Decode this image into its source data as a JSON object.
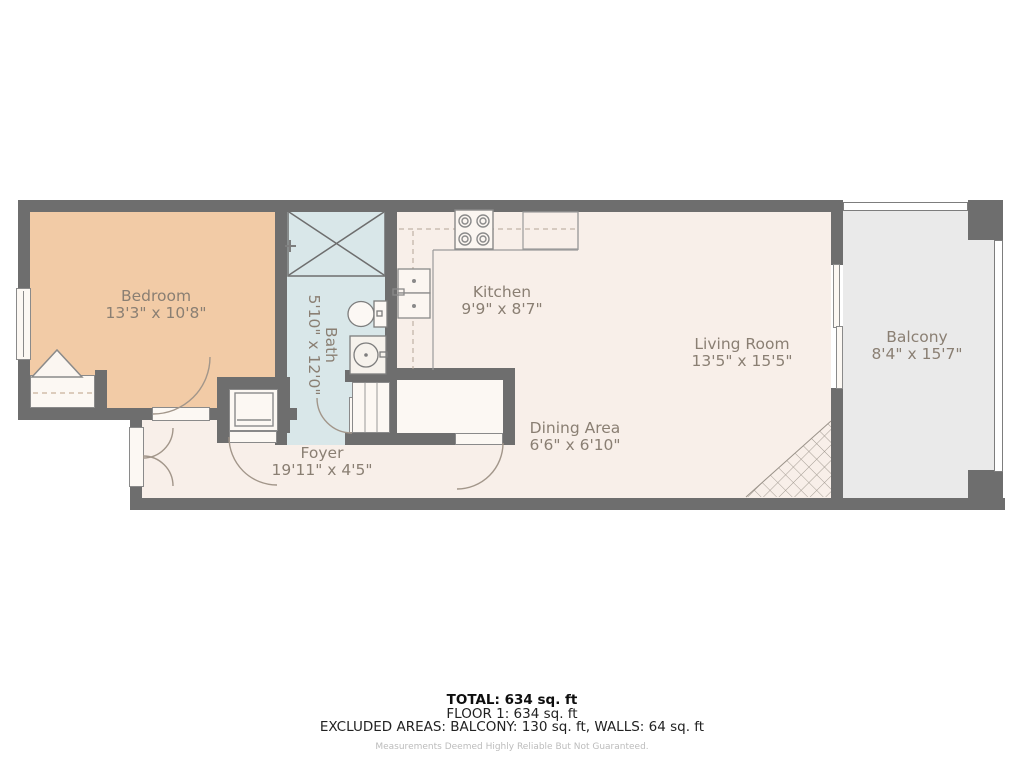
{
  "rooms": {
    "bedroom": {
      "name": "Bedroom",
      "dims": "13'3\" x 10'8\""
    },
    "bath": {
      "name": "Bath",
      "dims": "5'10\" x 12'0\""
    },
    "kitchen": {
      "name": "Kitchen",
      "dims": "9'9\" x 8'7\""
    },
    "living_room": {
      "name": "Living Room",
      "dims": "13'5\" x 15'5\""
    },
    "dining_area": {
      "name": "Dining Area",
      "dims": "6'6\" x 6'10\""
    },
    "foyer": {
      "name": "Foyer",
      "dims": "19'11\" x 4'5\""
    },
    "balcony": {
      "name": "Balcony",
      "dims": "8'4\" x 15'7\""
    }
  },
  "summary": {
    "total": "TOTAL: 634 sq. ft",
    "floor": "FLOOR 1: 634 sq. ft",
    "excluded": "EXCLUDED AREAS: BALCONY: 130 sq. ft, WALLS: 64 sq. ft",
    "disclaimer": "Measurements Deemed Highly Reliable But Not Guaranteed."
  },
  "colors": {
    "wall": "#6e6e6e",
    "bedroom_floor": "#f2cba6",
    "bath_floor": "#d9e7e9",
    "main_floor": "#f8efe9",
    "balcony_floor": "#eaeaea",
    "label_text": "#8a7f73"
  }
}
